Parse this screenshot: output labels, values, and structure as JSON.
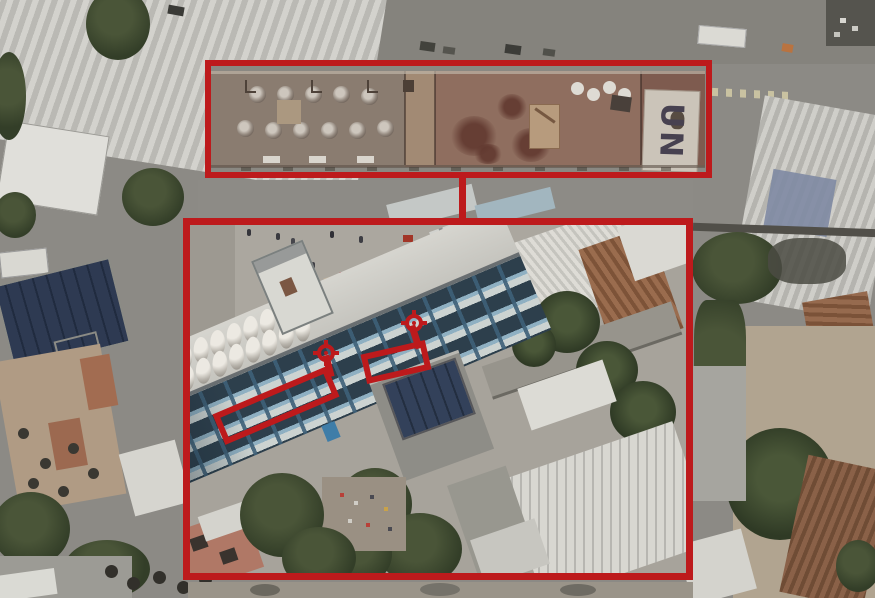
{
  "scene": {
    "type": "annotated-aerial-photograph",
    "roof_marking": "UN",
    "top_inset": "long-rooftop-with-water-tanks",
    "bottom_inset": "school-building-oblique-view"
  },
  "annotation": {
    "color": "#bd1a1c",
    "crosshair_count": 2,
    "highlight_band_count": 2
  }
}
